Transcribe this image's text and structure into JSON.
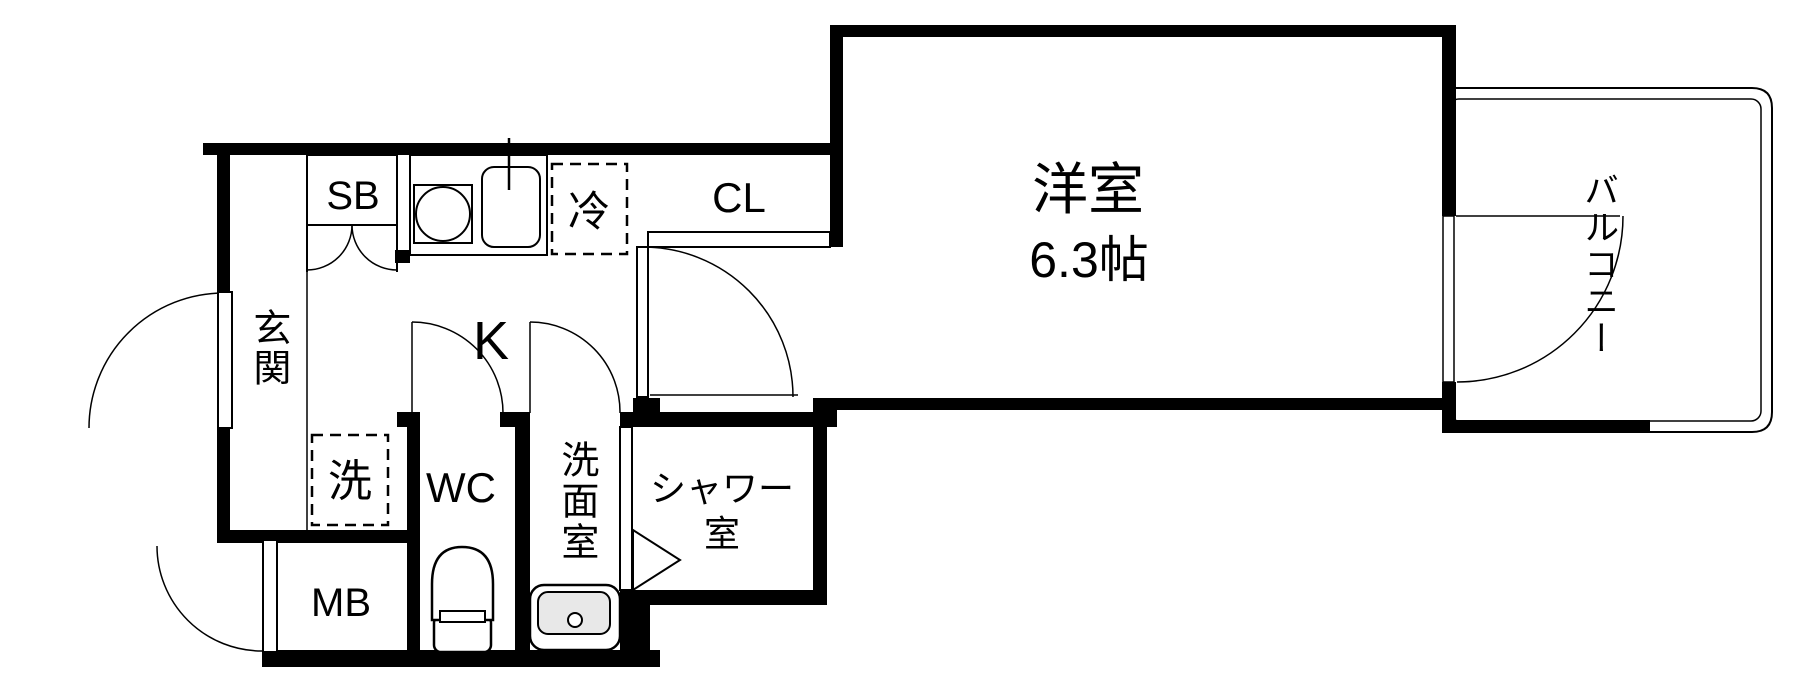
{
  "floorplan": {
    "labels": {
      "entrance": "玄関",
      "shoe_box": "SB",
      "kitchen": "K",
      "refrigerator": "冷",
      "closet": "CL",
      "western_room": "洋室",
      "western_room_size": "6.3帖",
      "washer": "洗",
      "toilet": "WC",
      "meter_box": "MB",
      "washroom": "洗面室",
      "shower_room": "シャワー\n室",
      "balcony": "バルコニー"
    },
    "colors": {
      "wall": "#000000",
      "background": "#ffffff",
      "basin": "#e8e8e8"
    }
  }
}
